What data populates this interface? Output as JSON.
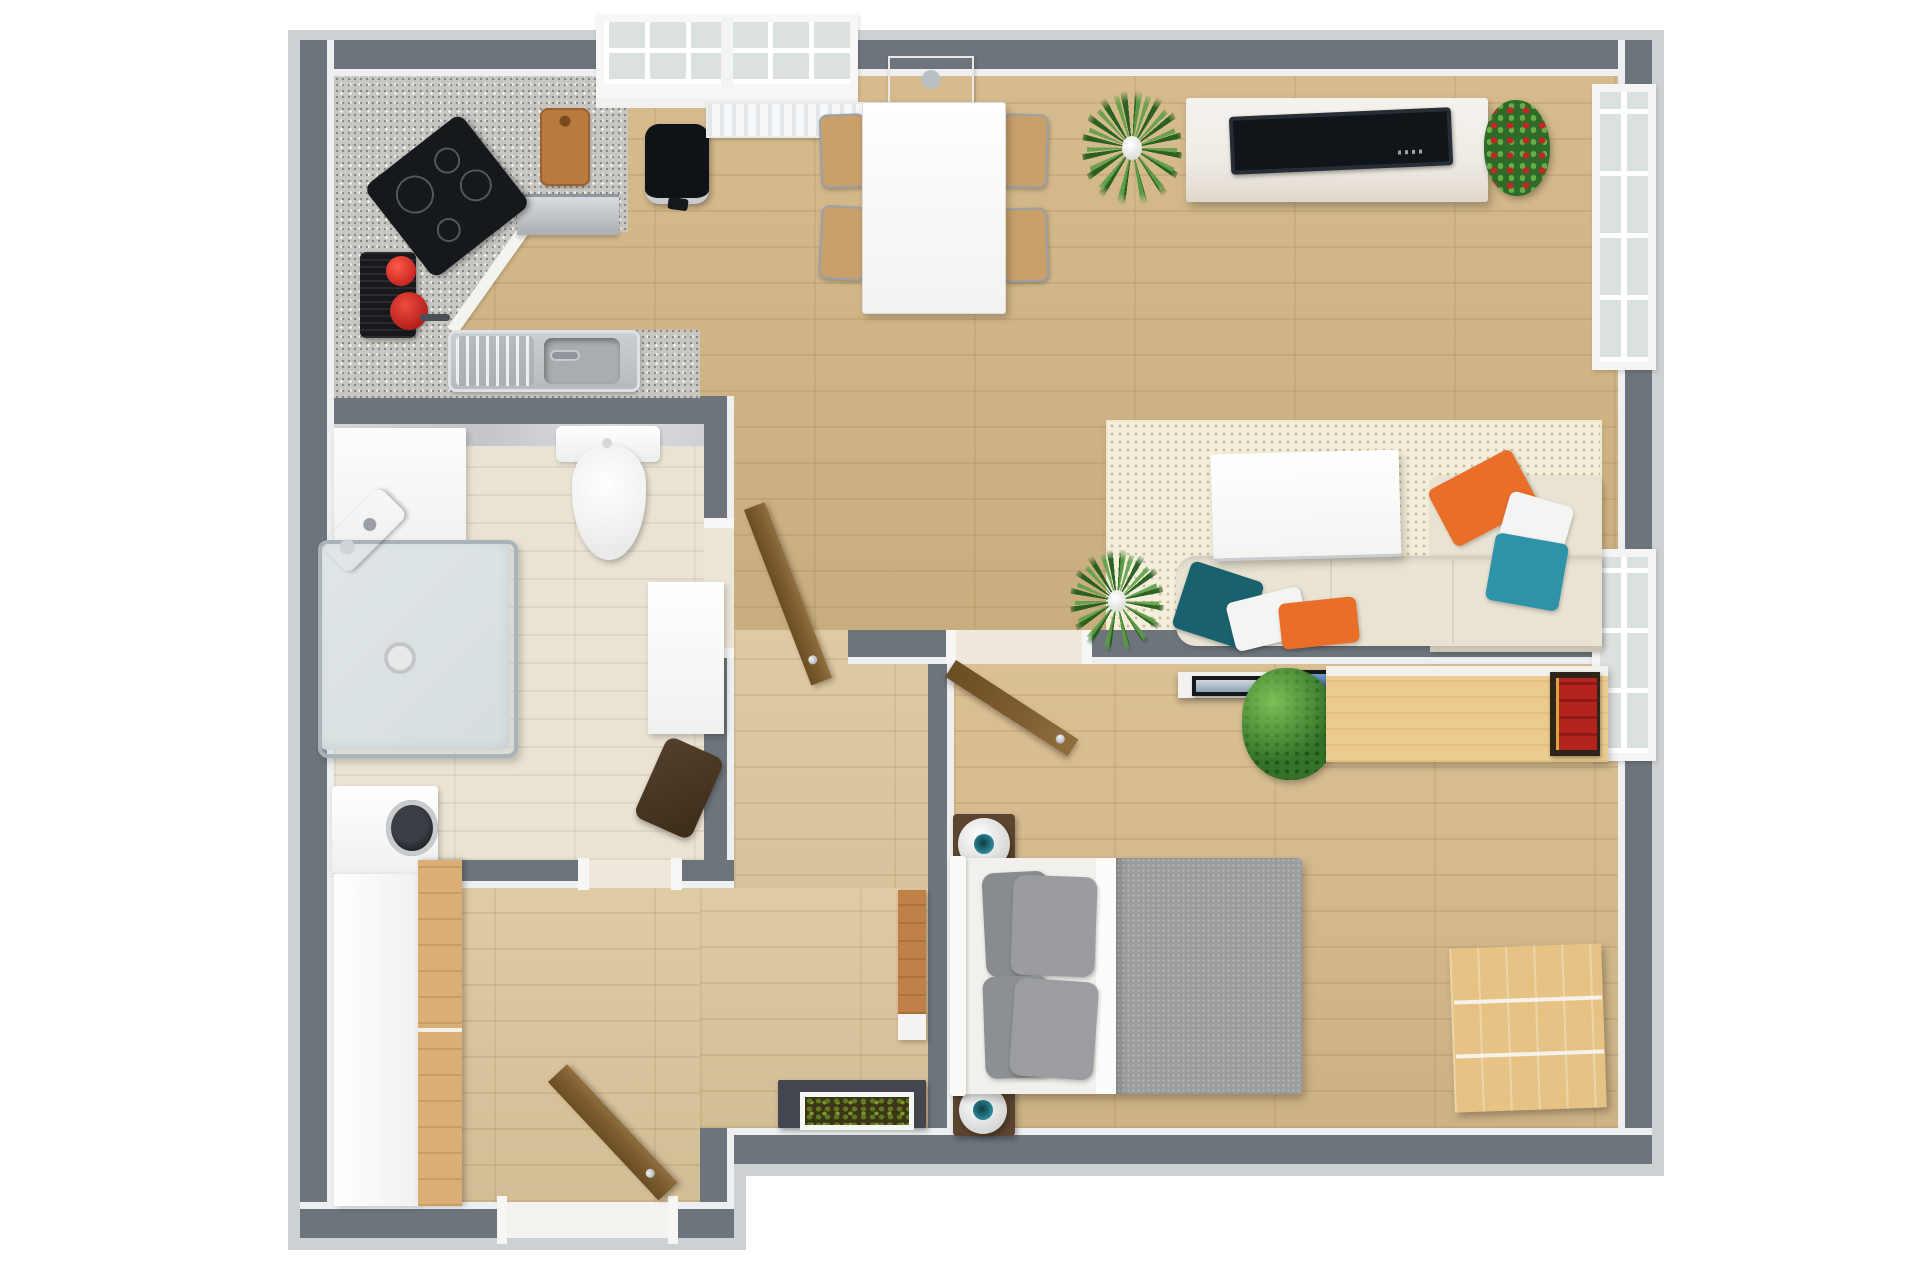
{
  "scene": {
    "type": "3d-top-down-floor-plan",
    "background": "#ffffff",
    "rooms": [
      "kitchen",
      "dining-area",
      "living-area",
      "bathroom",
      "hallway",
      "bedroom",
      "second-room"
    ]
  },
  "palette": {
    "wall": "#6d747c",
    "wallFace": "#edeff0",
    "woodMain": "#d3b685",
    "woodBedroom": "#d7bb8c",
    "woodHall": "#dcc69c",
    "woodBottom": "#ddc79d",
    "bathFloor": "#eae3d4",
    "granite": "#c8c7c2",
    "marble": "#d6d7d9",
    "rug": "#f4eedb",
    "sofa": "#e9e3d3",
    "pillowOrange": "#e96f29",
    "pillowTeal": "#2f93a8",
    "pillowTealDark": "#1a616f",
    "pillowGray": "#8f9295",
    "blanket": "#9a9c9e",
    "doorWood": "#7d5d30",
    "furnWood": "#d9af75",
    "deskWood": "#eccc8e",
    "dresserWood": "#e6c384",
    "console": "#43464c",
    "tv": "#21272d",
    "applianceBlack": "#15181c",
    "steel": "#bcc0c4",
    "green": "#3a7a2e",
    "greenLight": "#6cb34a",
    "flowerRed": "#c42525",
    "lampTeal": "#2e8b9a",
    "cream": "#efece6",
    "windowGlass": "#dbe0e0",
    "white": "#fafafa"
  }
}
